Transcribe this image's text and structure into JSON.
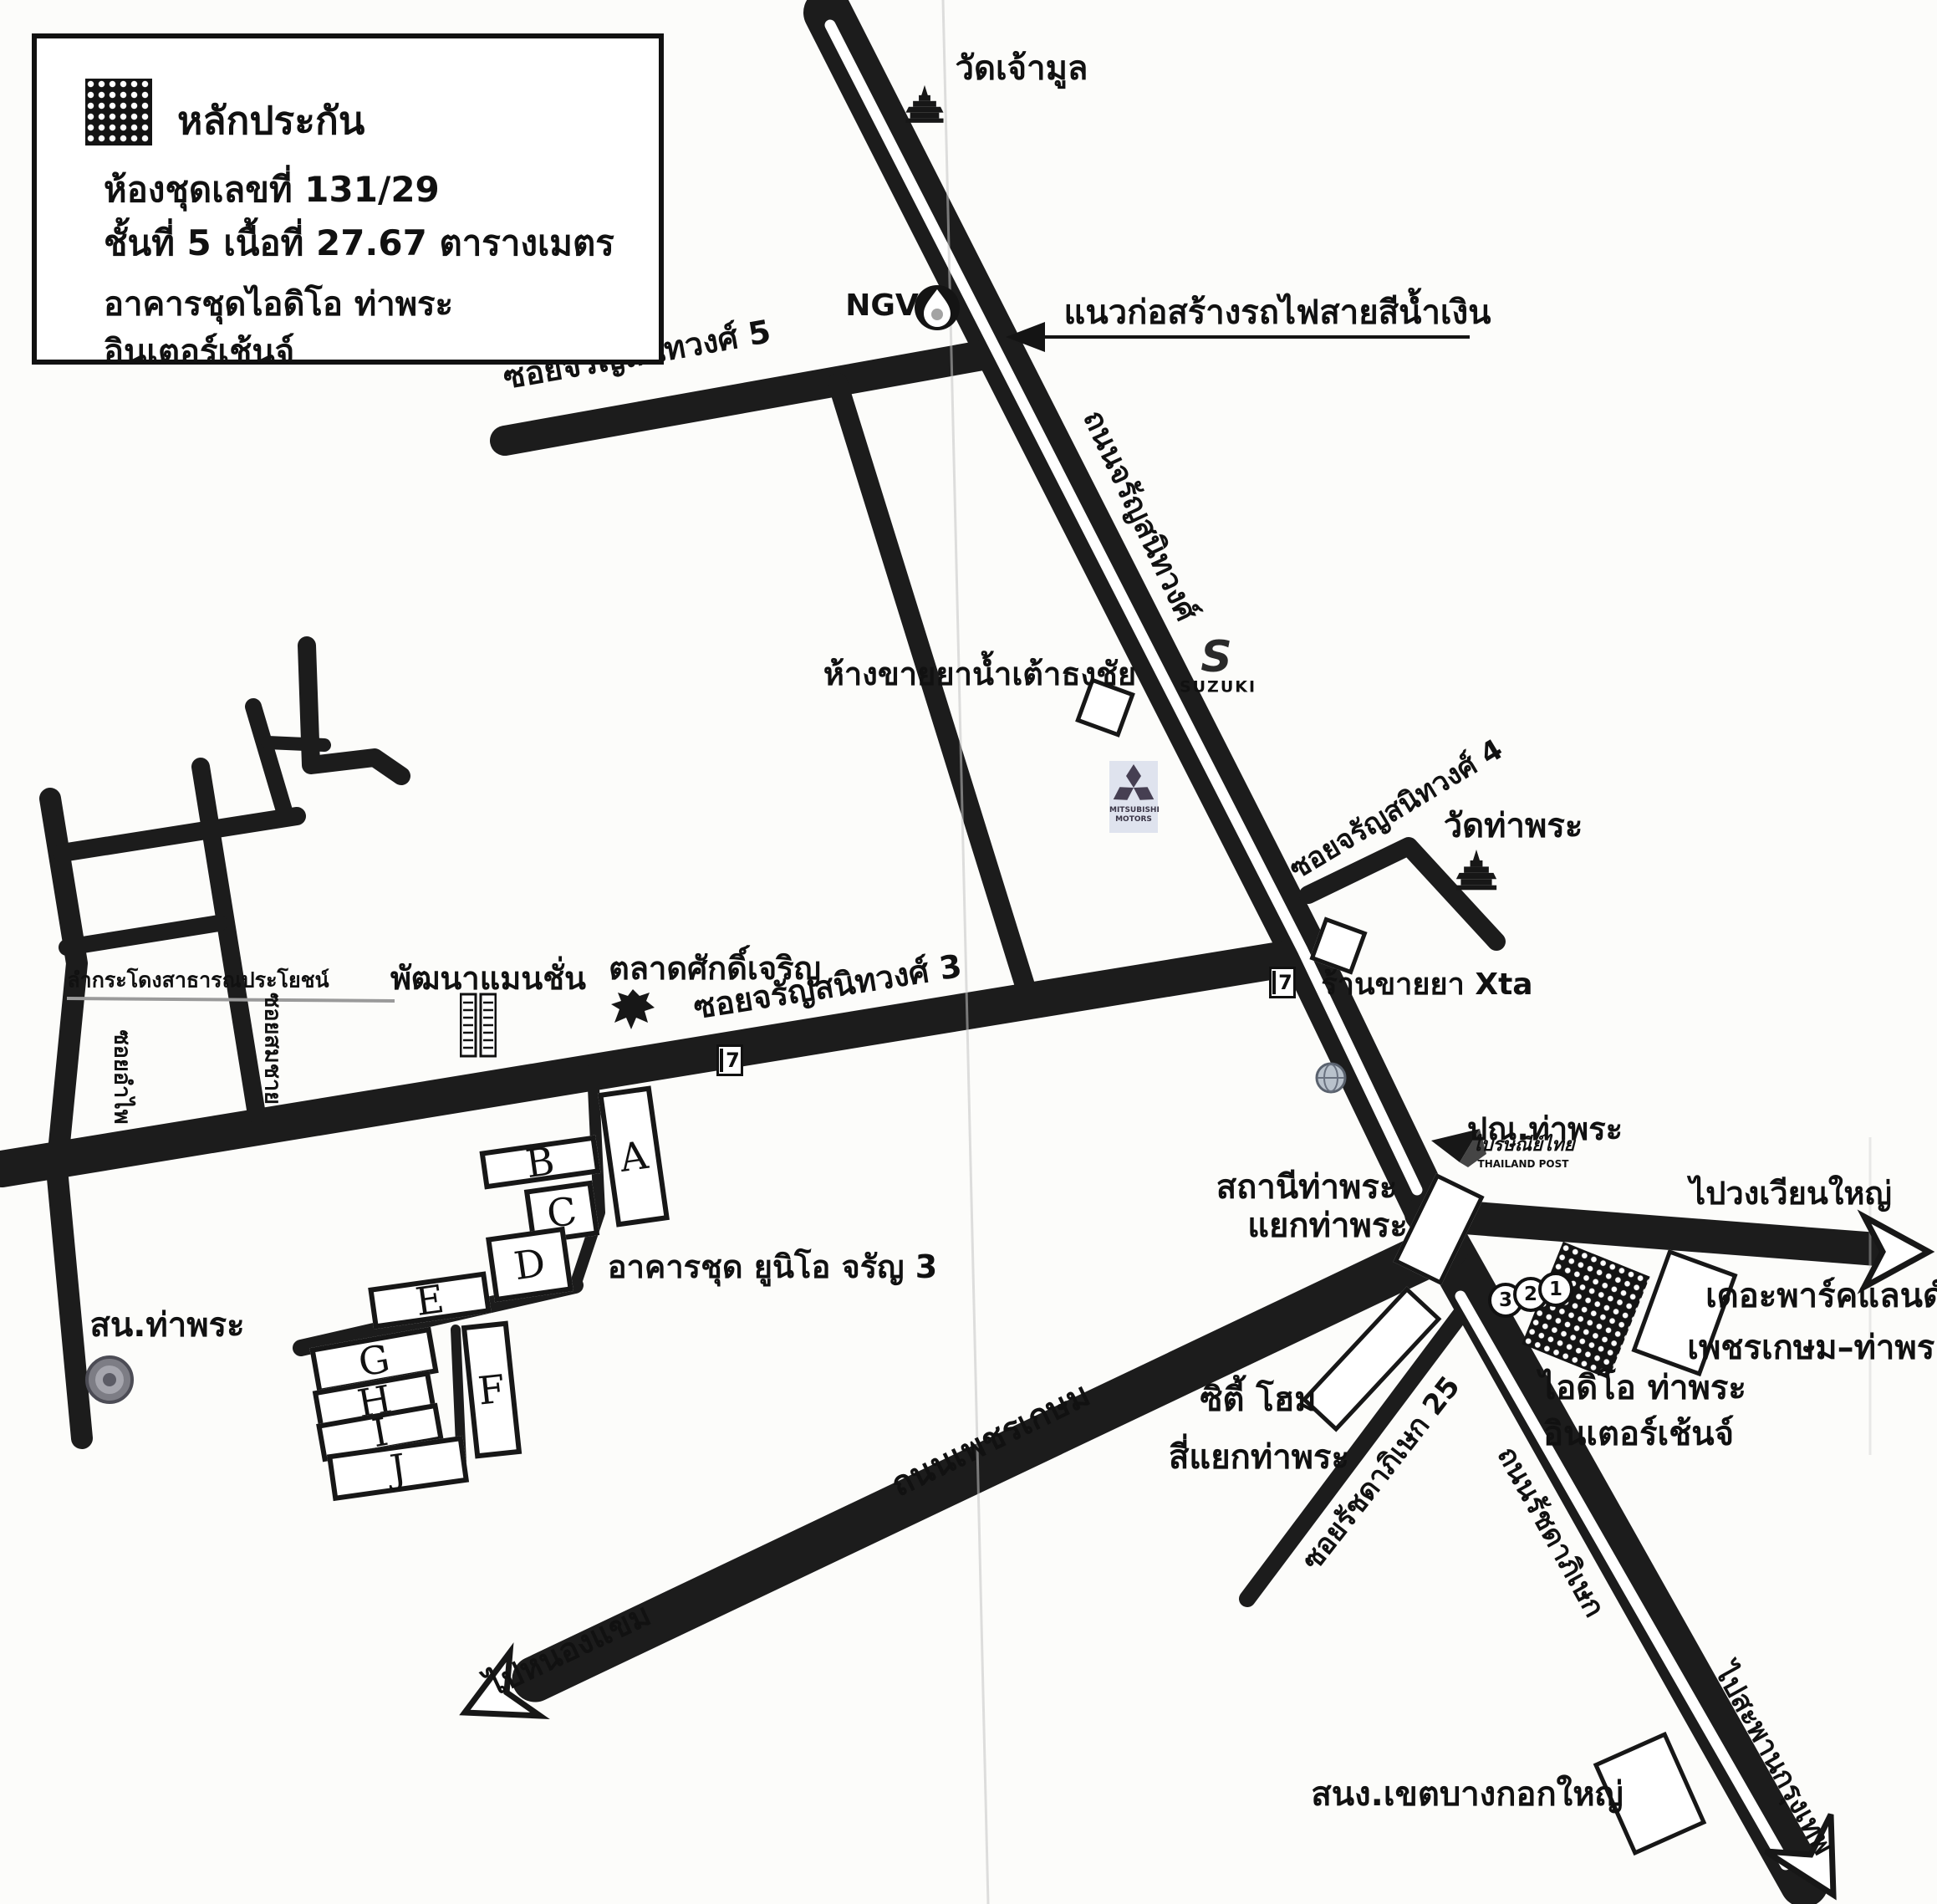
{
  "legend": {
    "title": "หลักประกัน",
    "unit_line": "ห้องชุดเลขที่ 131/29",
    "floor_area_line": "ชั้นที่ 5  เนื้อที่ 27.67  ตารางเมตร",
    "building_line1": "อาคารชุดไอดิโอ ท่าพระ",
    "building_line2": "อินเตอร์เช้นจ์"
  },
  "mrt_note": "แนวก่อสร้างรถไฟสายสีน้ำเงิน",
  "roads": {
    "charansanitwong": "ถนนจรัญสนิทวงศ์",
    "soi_charansanitwong_5": "ซอยจรัญสนิทวงศ์ 5",
    "soi_charansanitwong_4": "ซอยจรัญสนิทวงศ์ 4",
    "soi_charansanitwong_3": "ซอยจรัญสนิทวงศ์ 3",
    "phetkasem": "ถนนเพชรเกษม",
    "ratchadaphisek": "ถนนรัชดาภิเษก",
    "soi_ratchadaphisek_25": "ซอยรัชดาภิเษก 25",
    "soi_amphai": "ซอยอำไพ",
    "soi_somchai": "ซอยสมชาย",
    "canal": "ลำกระโดงสาธารณประโยชน์"
  },
  "directions": {
    "wongwian_yai": "ไปวงเวียนใหญ่",
    "nong_khaem": "ไปหนองแขม",
    "krung_thep_bridge": "ไปสะพานกรุงเทพ"
  },
  "places": {
    "wat_chao_mun": "วัดเจ้ามูล",
    "wat_tha_phra": "วัดท่าพระ",
    "drugstore_namtao_thongchai": "ห้างขายยาน้ำเต้าธงชัย",
    "drugstore_xta": "ร้านขายยา Xta",
    "pattana_mansion": "พัฒนาแมนชั่น",
    "sak_charoen_market": "ตลาดศักดิ์เจริญ",
    "tha_phra_police_station": "สน.ท่าพระ",
    "unio_condo": "อาคารชุด ยูนิโอ จรัญ 3",
    "tha_phra_station": "สถานีท่าพระ",
    "tha_phra_junction": "แยกท่าพระ",
    "tha_phra_post_office": "ปณ.ท่าพระ",
    "parkland_line1": "เดอะพาร์คแลนด์",
    "parkland_line2": "เพชรเกษม–ท่าพระ",
    "ideo_line1": "ไอดิโอ ท่าพระ",
    "ideo_line2": "อินเตอร์เช้นจ์",
    "city_home": "ซิตี้ โฮม",
    "si_yaek_tha_phra": "สี่แยกท่าพระ",
    "bangkok_yai_district_office": "สนง.เขตบางกอกใหญ่"
  },
  "logos": {
    "ngv": "NGV",
    "suzuki_s": "S",
    "suzuki": "SUZUKI",
    "mitsubishi_line1": "MITSUBISHI",
    "mitsubishi_line2": "MOTORS",
    "thailand_post_th": "ไปรษณีย์ไทย",
    "thailand_post_en": "THAILAND POST",
    "seven_eleven": "7"
  },
  "buildings": [
    "A",
    "B",
    "C",
    "D",
    "E",
    "F",
    "G",
    "H",
    "I",
    "J"
  ],
  "route_numbers": [
    "3",
    "2",
    "1"
  ],
  "colors": {
    "road": "#1c1c1c",
    "background": "#fcfcfa",
    "text": "#111111"
  }
}
